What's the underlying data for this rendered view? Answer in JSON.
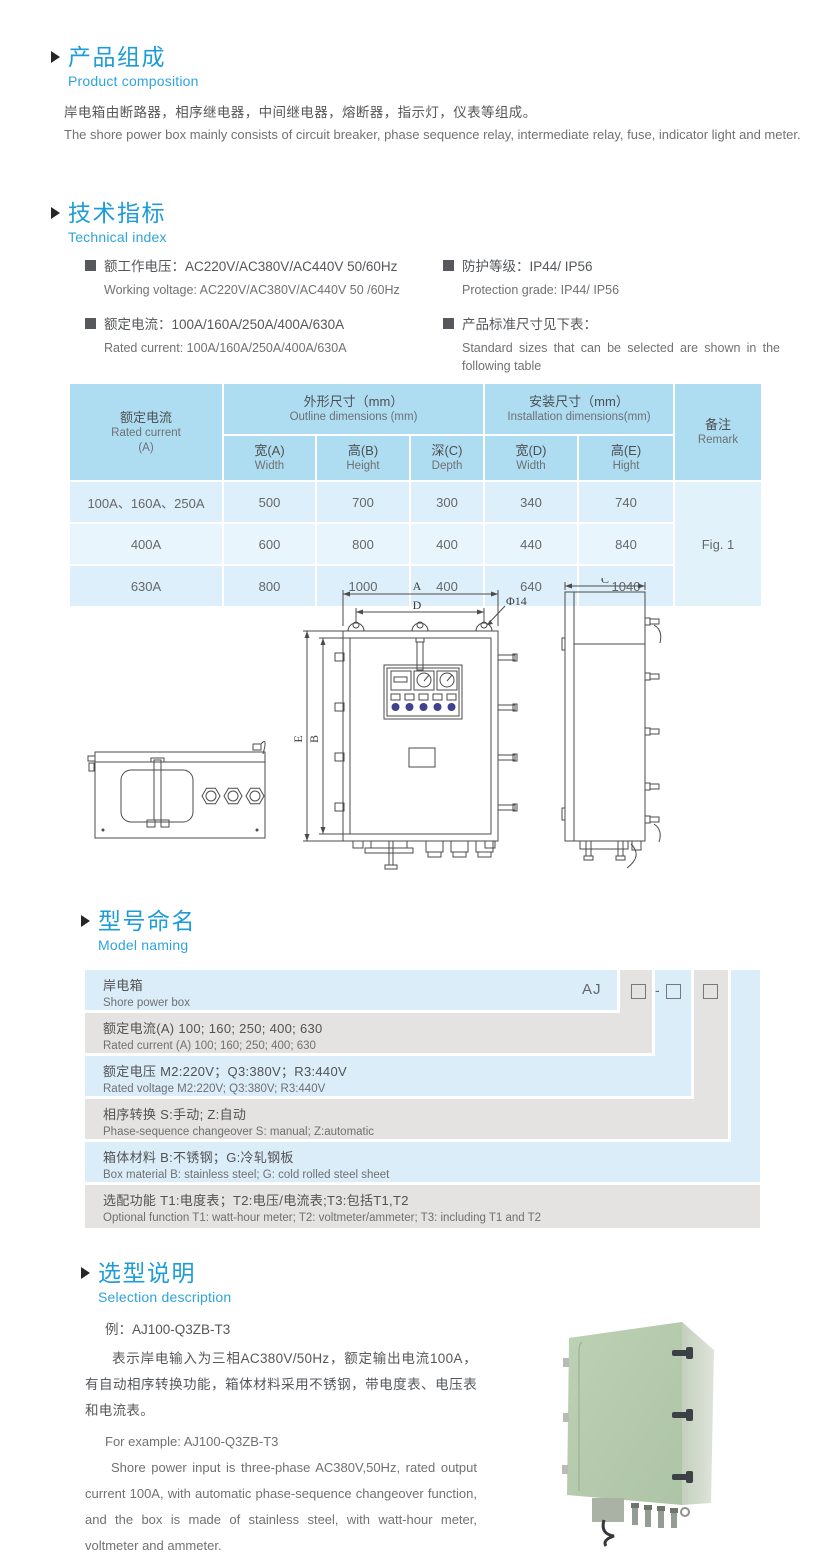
{
  "meta": {
    "accent_blue": "#1e9cd8",
    "subtitle_blue": "#2ea4dc",
    "text_dark": "#55575a",
    "text_light": "#707174",
    "table_header_bg": "#aeddf2",
    "table_row_odd": "#dc0effa",
    "table_row_even": "#e9f5fc",
    "model_row_blue": "#dbedf8",
    "model_row_gray": "#e4e3e1",
    "photo_green": "#b6cbae"
  },
  "composition": {
    "title_zh": "产品组成",
    "title_en": "Product  composition",
    "body_zh": "岸电箱由断路器，相序继电器，中间继电器，熔断器，指示灯，仪表等组成。",
    "body_en": "The shore power box mainly consists of circuit breaker, phase sequence relay, intermediate relay, fuse, indicator light and meter."
  },
  "technical": {
    "title_zh": "技术指标",
    "title_en": "Technical index",
    "specs": [
      {
        "zh": "额工作电压：AC220V/AC380V/AC440V  50/60Hz",
        "en": "Working voltage: AC220V/AC380V/AC440V 50 /60Hz"
      },
      {
        "zh": "额定电流：100A/160A/250A/400A/630A",
        "en": "Rated current: 100A/160A/250A/400A/630A"
      },
      {
        "zh": "防护等级：IP44/ IP56",
        "en": "Protection grade: IP44/ IP56"
      },
      {
        "zh": "产品标准尺寸见下表：",
        "en": "Standard sizes that can be selected are shown in the following table"
      }
    ],
    "table": {
      "head": {
        "rated_zh": "额定电流",
        "rated_en": "Rated current",
        "rated_unit": "(A)",
        "outline_zh": "外形尺寸（mm）",
        "outline_en": "Outline dimensions (mm)",
        "install_zh": "安装尺寸（mm）",
        "install_en": "Installation dimensions(mm)",
        "w_zh": "宽(A)",
        "w_en": "Width",
        "h_zh": "高(B)",
        "h_en": "Height",
        "d_zh": "深(C)",
        "d_en": "Depth",
        "iw_zh": "宽(D)",
        "iw_en": "Width",
        "ih_zh": "高(E)",
        "ih_en": "Hight",
        "remark_zh": "备注",
        "remark_en": "Remark"
      },
      "rows": [
        {
          "current": "100A、160A、250A",
          "w": "500",
          "h": "700",
          "d": "300",
          "iw": "340",
          "ih": "740"
        },
        {
          "current": "400A",
          "w": "600",
          "h": "800",
          "d": "400",
          "iw": "440",
          "ih": "840"
        },
        {
          "current": "630A",
          "w": "800",
          "h": "1000",
          "d": "400",
          "iw": "640",
          "ih": "1040"
        }
      ],
      "remark_value": "Fig. 1"
    }
  },
  "drawing": {
    "labels": {
      "a": "A",
      "b": "B",
      "c": "C",
      "d": "D",
      "e": "E",
      "dia": "Φ14"
    }
  },
  "model": {
    "title_zh": "型号命名",
    "title_en": "Model naming",
    "prefix": "AJ",
    "box_dash": "-",
    "rows": [
      {
        "line1": "岸电箱",
        "line2": "Shore power box"
      },
      {
        "line1": "额定电流(A)  100; 160; 250; 400; 630",
        "line2": "Rated current (A) 100; 160; 250; 400; 630"
      },
      {
        "line1": "额定电压  M2:220V；Q3:380V；R3:440V",
        "line2": "Rated voltage  M2:220V;  Q3:380V;  R3:440V"
      },
      {
        "line1": "相序转换  S:手动; Z:自动",
        "line2": "Phase-sequence changeover  S: manual;  Z:automatic"
      },
      {
        "line1": "箱体材料  B:不锈钢；G:冷轧钢板",
        "line2": "Box material  B: stainless steel; G: cold rolled steel sheet"
      },
      {
        "line1": "选配功能  T1:电度表；T2:电压/电流表;T3:包括T1,T2",
        "line2": "Optional function  T1: watt-hour meter; T2: voltmeter/ammeter; T3: including T1 and T2"
      }
    ]
  },
  "selection": {
    "title_zh": "选型说明",
    "title_en": "Selection description",
    "example_zh": "例：AJ100-Q3ZB-T3",
    "desc_zh": "表示岸电输入为三相AC380V/50Hz，额定输出电流100A，有自动相序转换功能，箱体材料采用不锈钢，带电度表、电压表和电流表。",
    "example_en": "For example: AJ100-Q3ZB-T3",
    "desc_en": "Shore power input is three-phase AC380V,50Hz, rated output current 100A, with automatic phase-sequence changeover function, and the box is made of stainless steel, with watt-hour meter, voltmeter and ammeter."
  }
}
